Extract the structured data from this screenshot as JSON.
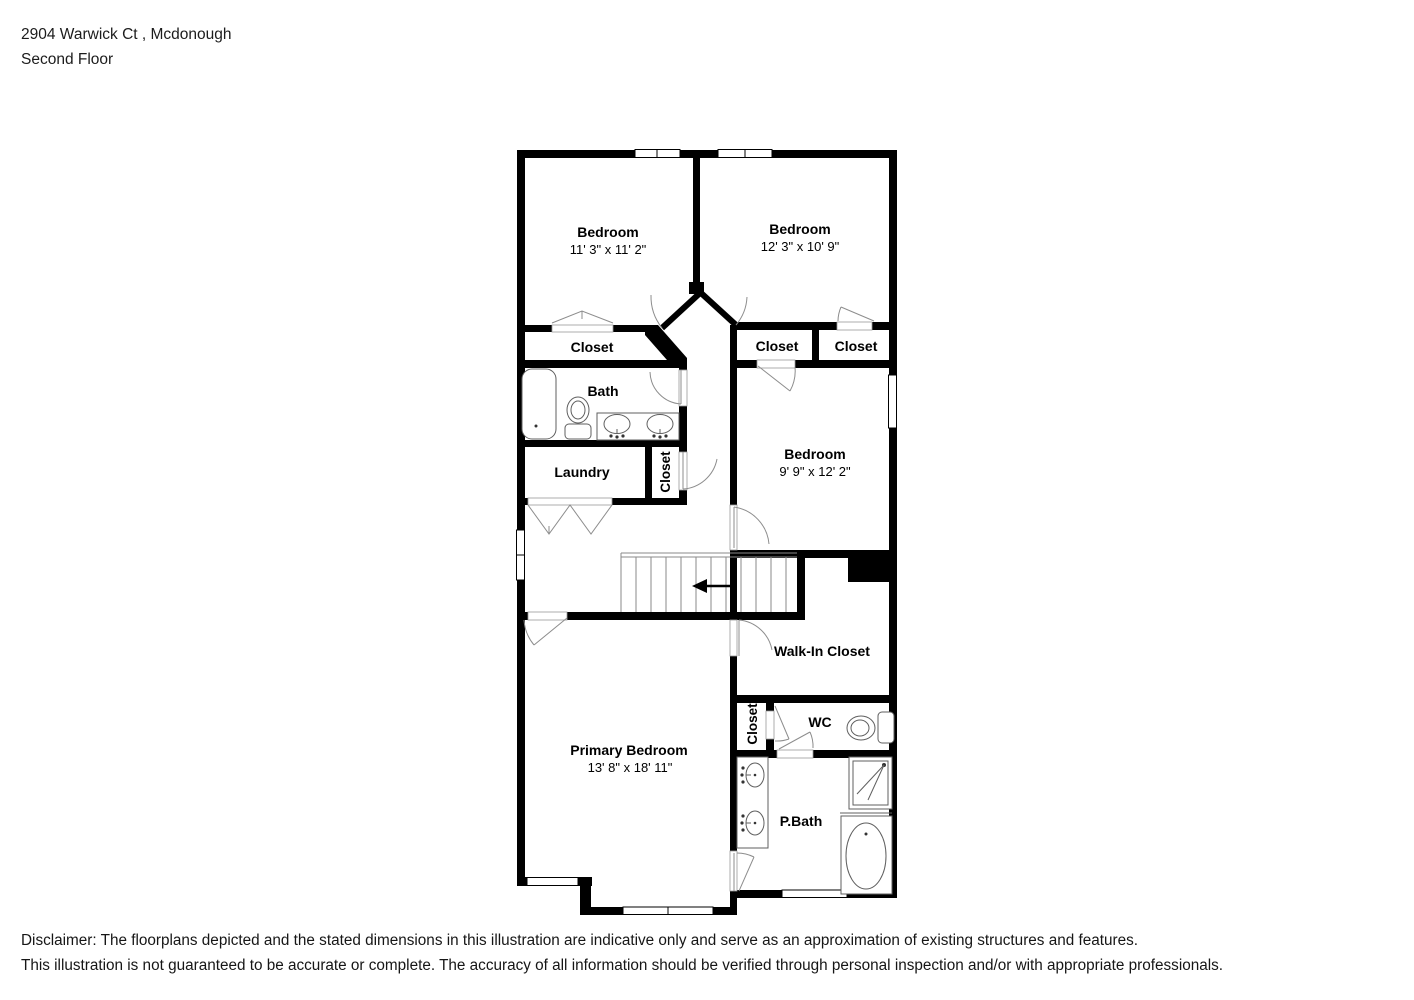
{
  "header": {
    "address": "2904 Warwick Ct , Mcdonough",
    "floor_label": "Second Floor"
  },
  "floorplan": {
    "rooms": {
      "bedroom_top_left": {
        "label": "Bedroom",
        "dims": "11' 3\" x 11' 2\""
      },
      "bedroom_top_right": {
        "label": "Bedroom",
        "dims": "12' 3\" x 10' 9\""
      },
      "bedroom_mid_right": {
        "label": "Bedroom",
        "dims": "9' 9\" x 12' 2\""
      },
      "primary_bedroom": {
        "label": "Primary Bedroom",
        "dims": "13' 8\" x 18' 11\""
      },
      "closet_bedroom_1": {
        "label": "Closet"
      },
      "closet_bedroom_3": {
        "label": "Closet"
      },
      "closet_bedroom_2": {
        "label": "Closet"
      },
      "bath": {
        "label": "Bath"
      },
      "laundry": {
        "label": "Laundry"
      },
      "closet_hall": {
        "label": "Closet"
      },
      "walk_in_closet": {
        "label": "Walk-In Closet"
      },
      "closet_primary": {
        "label": "Closet"
      },
      "wc": {
        "label": "WC"
      },
      "primary_bath": {
        "label": "P.Bath"
      }
    }
  },
  "disclaimer": {
    "line1": "Disclaimer: The floorplans depicted and the stated dimensions in this illustration are indicative only and serve as an approximation of existing structures and features.",
    "line2": "This illustration is not guaranteed to be accurate or complete. The accuracy of all information should be verified through personal inspection and/or with appropriate professionals."
  }
}
